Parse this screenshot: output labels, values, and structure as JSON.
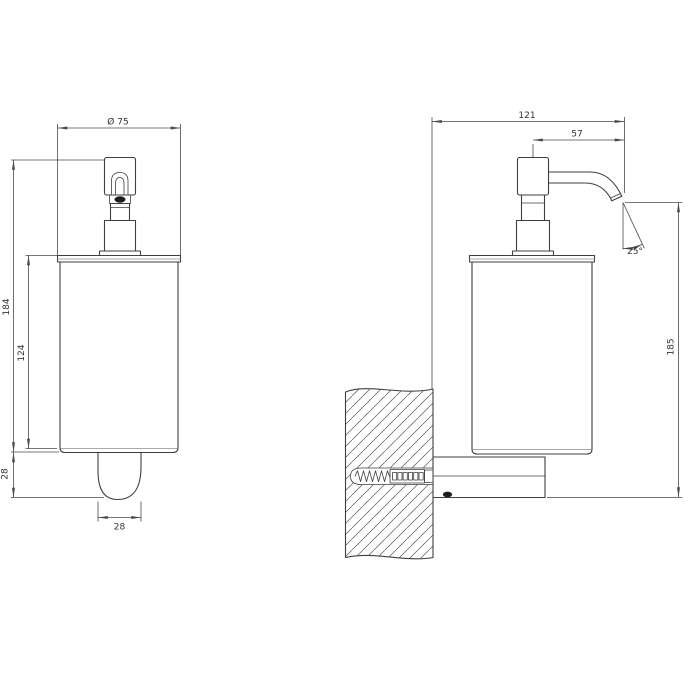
{
  "drawing": {
    "kind": "technical-drawing",
    "background_color": "#ffffff",
    "object_line_color": "#3f3f3f",
    "dimension_line_color": "#4a4a4a",
    "front_view": {
      "dim_diameter": "Ø 75",
      "dim_total_height": "184",
      "dim_body_height": "124",
      "dim_outlet_height": "28",
      "dim_outlet_width": "28"
    },
    "side_view": {
      "dim_total_depth": "121",
      "dim_spout_reach": "57",
      "dim_spout_angle": "25°",
      "dim_overall_height": "185"
    }
  }
}
